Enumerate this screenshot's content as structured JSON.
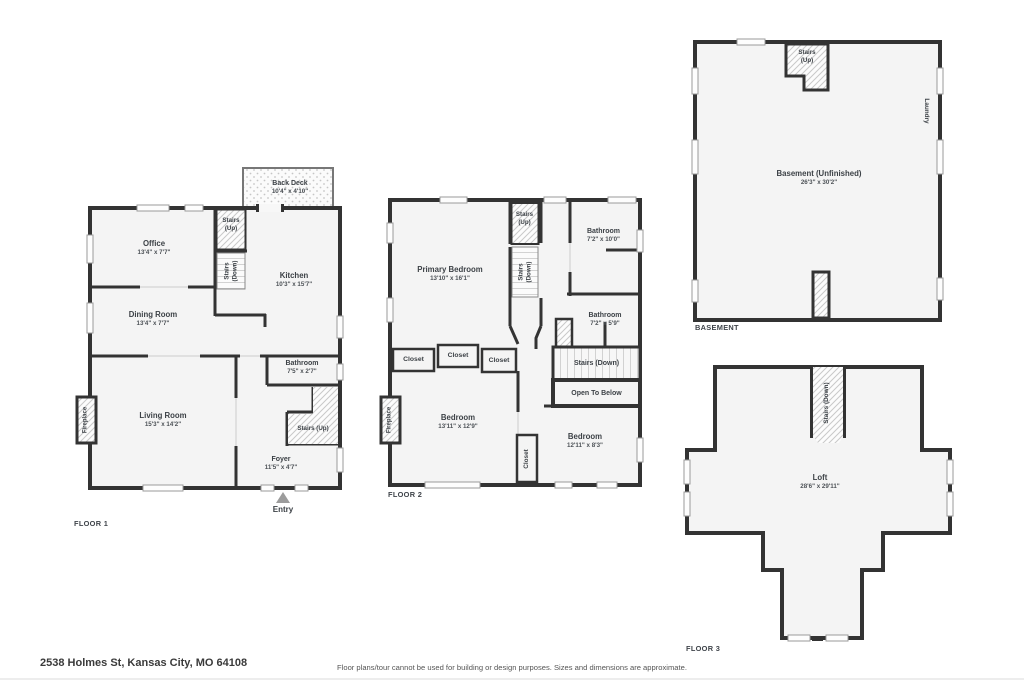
{
  "address": "2538 Holmes St, Kansas City, MO 64108",
  "disclaimer": "Floor plans/tour cannot be used for building or design purposes. Sizes and dimensions are approximate.",
  "colors": {
    "wall": "#333333",
    "floor_fill": "#f4f4f4",
    "text": "#3c4146"
  },
  "floor1": {
    "label": "FLOOR 1",
    "back_deck": {
      "name": "Back Deck",
      "dims": "10'4\" x 4'10\""
    },
    "office": {
      "name": "Office",
      "dims": "13'4\" x 7'7\""
    },
    "stairs_up_top": "Stairs (Up)",
    "stairs_down": "Stairs (Down)",
    "kitchen": {
      "name": "Kitchen",
      "dims": "10'3\" x 15'7\""
    },
    "dining_room": {
      "name": "Dining Room",
      "dims": "13'4\" x 7'7\""
    },
    "bathroom": {
      "name": "Bathroom",
      "dims": "7'5\" x 2'7\""
    },
    "living_room": {
      "name": "Living Room",
      "dims": "15'3\" x 14'2\""
    },
    "stairs_up": "Stairs (Up)",
    "foyer": {
      "name": "Foyer",
      "dims": "11'5\" x 4'7\""
    },
    "fireplace": "Fireplace",
    "entry": "Entry"
  },
  "floor2": {
    "label": "FLOOR 2",
    "primary_bedroom": {
      "name": "Primary Bedroom",
      "dims": "13'10\" x 16'1\""
    },
    "stairs_up": "Stairs (Up)",
    "stairs_down_upper": "Stairs (Down)",
    "bathroom_top": {
      "name": "Bathroom",
      "dims": "7'2\" x 10'0\""
    },
    "bathroom_mid": {
      "name": "Bathroom",
      "dims": "7'2\" x 5'9\""
    },
    "closet_a": "Closet",
    "closet_b": "Closet",
    "closet_c": "Closet",
    "closet_d": "Closet",
    "stairs_down": "Stairs (Down)",
    "open_to_below": "Open To Below",
    "bedroom_left": {
      "name": "Bedroom",
      "dims": "13'11\" x 12'9\""
    },
    "bedroom_right": {
      "name": "Bedroom",
      "dims": "12'11\" x 8'3\""
    },
    "fireplace": "Fireplace"
  },
  "basement": {
    "label": "BASEMENT",
    "room": {
      "name": "Basement (Unfinished)",
      "dims": "26'3\" x 30'2\""
    },
    "stairs_up": "Stairs (Up)",
    "laundry": "Laundry"
  },
  "floor3": {
    "label": "FLOOR 3",
    "loft": {
      "name": "Loft",
      "dims": "28'6\" x 29'11\""
    },
    "stairs_down": "Stairs (Down)"
  }
}
